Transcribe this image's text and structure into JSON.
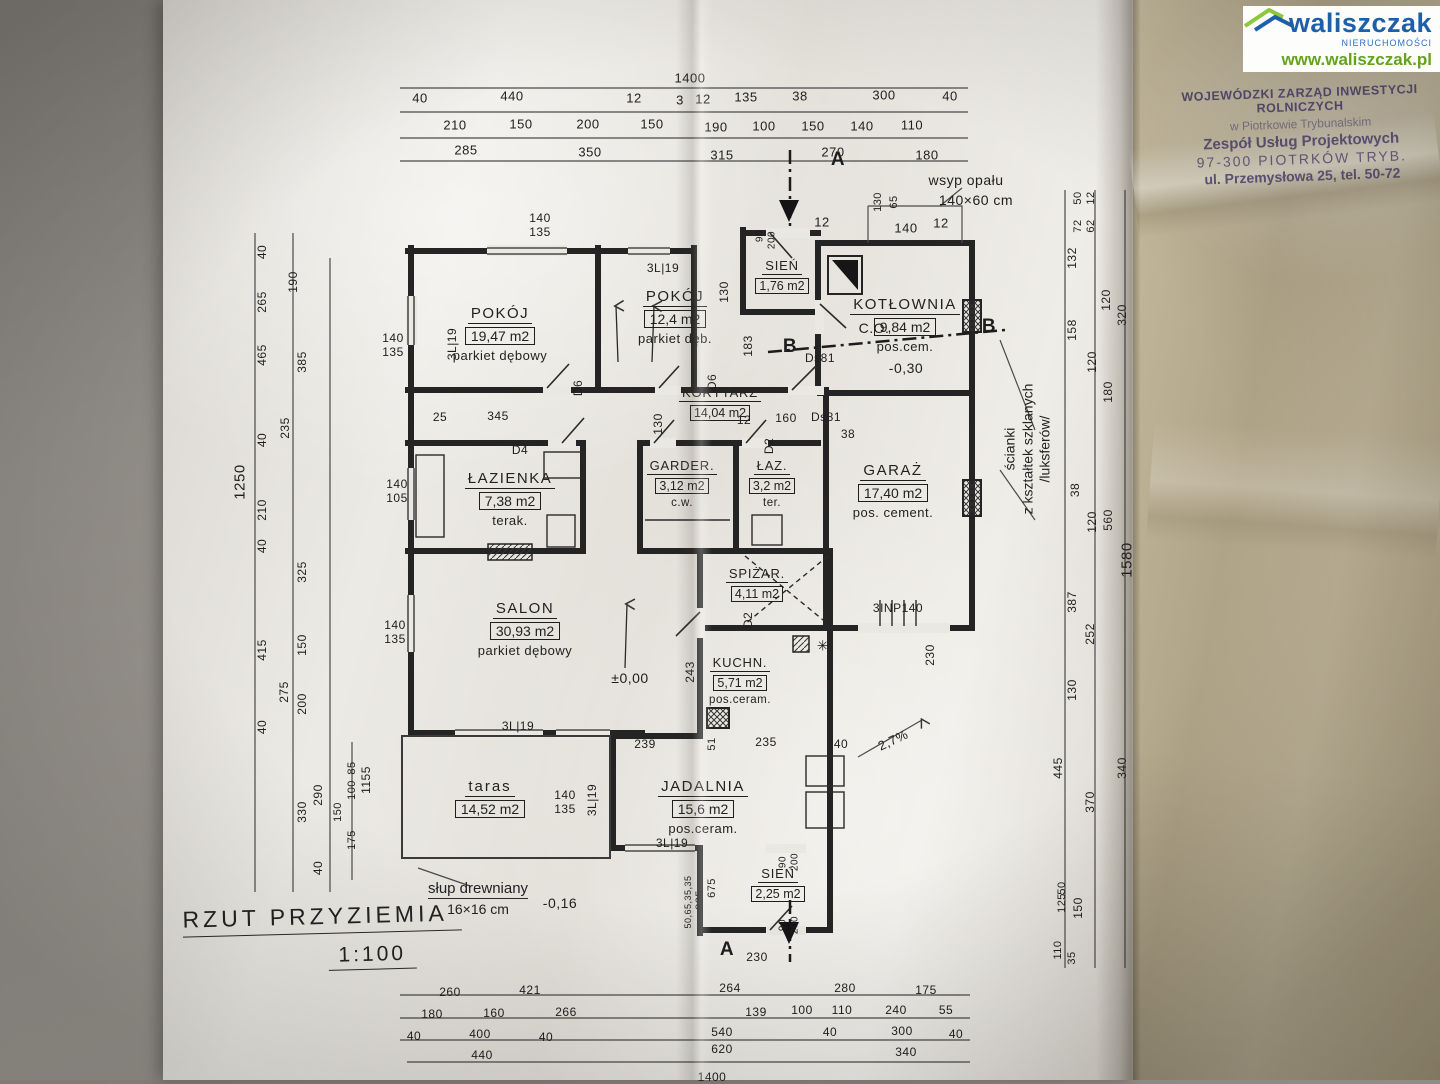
{
  "watermark": {
    "brand": "waliszczak",
    "subtitle": "NIERUCHOMOŚCI",
    "url": "www.waliszczak.pl",
    "brand_color": "#1d5fa8",
    "accent_green": "#8dc63f",
    "url_color": "#64a31c"
  },
  "stamp": {
    "line1": "WOJEWÓDZKI ZARZĄD INWESTYCJI ROLNICZYCH",
    "line2": "w Piotrkowie Trybunalskim",
    "line3": "Zespół Usług Projektowych",
    "line4": "97-300 PIOTRKÓW TRYB.",
    "line5": "ul. Przemysłowa 25, tel. 50-72",
    "ink_color": "#3d3560"
  },
  "title": {
    "text": "RZUT PRZYZIEMIA",
    "scale": "1:100"
  },
  "rooms": [
    {
      "name": "POKÓJ",
      "area": "19,47 m2",
      "floor": "parkiet dębowy"
    },
    {
      "name": "POKÓJ",
      "area": "12,4 m2",
      "floor": "parkiet dęb."
    },
    {
      "name": "SIEŃ",
      "area": "1,76 m2",
      "floor": ""
    },
    {
      "name": "KOTŁOWNIA",
      "area": "9,84 m2",
      "floor": "pos.cem."
    },
    {
      "name": "KORYTARZ",
      "area": "14,04 m2",
      "floor": ""
    },
    {
      "name": "ŁAZIENKA",
      "area": "7,38 m2",
      "floor": "terak."
    },
    {
      "name": "GARDER.",
      "area": "3,12 m2",
      "floor": "c.w."
    },
    {
      "name": "ŁAZ.",
      "area": "3,2 m2",
      "floor": "ter."
    },
    {
      "name": "GARAŻ",
      "area": "17,40 m2",
      "floor": "pos. cement."
    },
    {
      "name": "SALON",
      "area": "30,93 m2",
      "floor": "parkiet dębowy"
    },
    {
      "name": "SPIŻAR.",
      "area": "4,11 m2",
      "floor": ""
    },
    {
      "name": "KUCHN.",
      "area": "5,71 m2",
      "floor": "pos.ceram."
    },
    {
      "name": "taras",
      "area": "14,52 m2",
      "floor": ""
    },
    {
      "name": "JADALNIA",
      "area": "15,6 m2",
      "floor": "pos.ceram."
    },
    {
      "name": "SIEŃ",
      "area": "2,25 m2",
      "floor": ""
    }
  ],
  "annotations": {
    "glass_wall": {
      "l1": "ścianki",
      "l2": "z kształtek szklanych",
      "l3": "/luksferów/"
    },
    "post": {
      "l1": "słup drewniany",
      "l2": "16×16 cm"
    },
    "coal_chute": "wsyp opału 140×60 cm",
    "levels": [
      "±0,00",
      "-0,30",
      "-0,16"
    ],
    "slope": "2,7%",
    "stairs": "3INP140",
    "doors": [
      "Ds81",
      "D2",
      "D4",
      "D6"
    ],
    "windows": [
      "3L|19"
    ],
    "sections": [
      "A",
      "B"
    ]
  },
  "plan": {
    "labels": [
      {
        "t": "1400",
        "x": 690,
        "y": 78
      },
      {
        "t": "40",
        "x": 420,
        "y": 98
      },
      {
        "t": "440",
        "x": 512,
        "y": 96
      },
      {
        "t": "12",
        "x": 634,
        "y": 98
      },
      {
        "t": "3",
        "x": 680,
        "y": 100
      },
      {
        "t": "12",
        "x": 703,
        "y": 99
      },
      {
        "t": "135",
        "x": 746,
        "y": 97
      },
      {
        "t": "38",
        "x": 800,
        "y": 96
      },
      {
        "t": "300",
        "x": 884,
        "y": 95
      },
      {
        "t": "40",
        "x": 950,
        "y": 96
      },
      {
        "t": "210",
        "x": 455,
        "y": 125
      },
      {
        "t": "150",
        "x": 521,
        "y": 124
      },
      {
        "t": "200",
        "x": 588,
        "y": 124
      },
      {
        "t": "150",
        "x": 652,
        "y": 124
      },
      {
        "t": "190",
        "x": 716,
        "y": 127
      },
      {
        "t": "100",
        "x": 764,
        "y": 126
      },
      {
        "t": "150",
        "x": 813,
        "y": 126
      },
      {
        "t": "140",
        "x": 862,
        "y": 126
      },
      {
        "t": "110",
        "x": 912,
        "y": 125
      },
      {
        "t": "285",
        "x": 466,
        "y": 150
      },
      {
        "t": "350",
        "x": 590,
        "y": 152
      },
      {
        "t": "315",
        "x": 722,
        "y": 155
      },
      {
        "t": "270",
        "x": 833,
        "y": 152
      },
      {
        "t": "180",
        "x": 927,
        "y": 155
      },
      {
        "t": "wsyp opału",
        "x": 966,
        "y": 180,
        "s": 14
      },
      {
        "t": "140×60 cm",
        "x": 976,
        "y": 200,
        "s": 14
      },
      {
        "t": "130",
        "x": 878,
        "y": 202,
        "r": -90,
        "s": 11
      },
      {
        "t": "65",
        "x": 894,
        "y": 202,
        "r": -90,
        "s": 11
      },
      {
        "t": "140",
        "x": 906,
        "y": 228
      },
      {
        "t": "12",
        "x": 941,
        "y": 223
      },
      {
        "t": "12",
        "x": 822,
        "y": 222
      },
      {
        "t": "90",
        "x": 760,
        "y": 236,
        "r": -90,
        "s": 10
      },
      {
        "t": "200",
        "x": 772,
        "y": 240,
        "r": -90,
        "s": 10
      },
      {
        "t": "130",
        "x": 724,
        "y": 292,
        "r": -90,
        "s": 12
      },
      {
        "t": "183",
        "x": 748,
        "y": 346,
        "r": -90,
        "s": 12
      },
      {
        "t": "Ds81",
        "x": 820,
        "y": 358,
        "s": 12
      },
      {
        "t": "C.O.",
        "x": 874,
        "y": 328,
        "s": 14
      },
      {
        "t": "-0,30",
        "x": 906,
        "y": 368,
        "s": 14
      },
      {
        "t": "B",
        "x": 790,
        "y": 347,
        "b": 1
      },
      {
        "t": "B",
        "x": 989,
        "y": 327,
        "b": 1
      },
      {
        "t": "A",
        "x": 838,
        "y": 160,
        "b": 1
      },
      {
        "t": "A",
        "x": 727,
        "y": 950,
        "b": 1
      },
      {
        "t": "40",
        "x": 262,
        "y": 252,
        "r": -90,
        "s": 12
      },
      {
        "t": "190",
        "x": 293,
        "y": 282,
        "r": -90,
        "s": 12
      },
      {
        "t": "265",
        "x": 262,
        "y": 302,
        "r": -90,
        "s": 12
      },
      {
        "t": "465",
        "x": 262,
        "y": 355,
        "r": -90,
        "s": 12
      },
      {
        "t": "385",
        "x": 302,
        "y": 362,
        "r": -90,
        "s": 12
      },
      {
        "t": "235",
        "x": 285,
        "y": 428,
        "r": -90,
        "s": 12
      },
      {
        "t": "40",
        "x": 262,
        "y": 440,
        "r": -90,
        "s": 12
      },
      {
        "t": "1250",
        "x": 240,
        "y": 482,
        "r": -90,
        "s": 15
      },
      {
        "t": "210",
        "x": 262,
        "y": 510,
        "r": -90,
        "s": 12
      },
      {
        "t": "40",
        "x": 262,
        "y": 546,
        "r": -90,
        "s": 12
      },
      {
        "t": "325",
        "x": 302,
        "y": 572,
        "r": -90,
        "s": 12
      },
      {
        "t": "415",
        "x": 262,
        "y": 650,
        "r": -90,
        "s": 12
      },
      {
        "t": "150",
        "x": 302,
        "y": 645,
        "r": -90,
        "s": 12
      },
      {
        "t": "275",
        "x": 284,
        "y": 692,
        "r": -90,
        "s": 12
      },
      {
        "t": "200",
        "x": 302,
        "y": 704,
        "r": -90,
        "s": 12
      },
      {
        "t": "40",
        "x": 262,
        "y": 727,
        "r": -90,
        "s": 12
      },
      {
        "t": "85",
        "x": 352,
        "y": 768,
        "r": -90,
        "s": 11
      },
      {
        "t": "100",
        "x": 352,
        "y": 790,
        "r": -90,
        "s": 11
      },
      {
        "t": "150",
        "x": 338,
        "y": 812,
        "r": -90,
        "s": 11
      },
      {
        "t": "175",
        "x": 352,
        "y": 840,
        "r": -90,
        "s": 11
      },
      {
        "t": "290",
        "x": 318,
        "y": 795,
        "r": -90,
        "s": 12
      },
      {
        "t": "330",
        "x": 302,
        "y": 812,
        "r": -90,
        "s": 12
      },
      {
        "t": "40",
        "x": 318,
        "y": 868,
        "r": -90,
        "s": 12
      },
      {
        "t": "1155",
        "x": 366,
        "y": 780,
        "r": -90,
        "s": 12
      },
      {
        "t": "50",
        "x": 1078,
        "y": 198,
        "r": -90,
        "s": 11
      },
      {
        "t": "12",
        "x": 1091,
        "y": 198,
        "r": -90,
        "s": 11
      },
      {
        "t": "72",
        "x": 1078,
        "y": 226,
        "r": -90,
        "s": 11
      },
      {
        "t": "62",
        "x": 1091,
        "y": 226,
        "r": -90,
        "s": 11
      },
      {
        "t": "132",
        "x": 1072,
        "y": 258,
        "r": -90,
        "s": 12
      },
      {
        "t": "120",
        "x": 1106,
        "y": 300,
        "r": -90,
        "s": 12
      },
      {
        "t": "320",
        "x": 1122,
        "y": 315,
        "r": -90,
        "s": 12
      },
      {
        "t": "158",
        "x": 1072,
        "y": 330,
        "r": -90,
        "s": 12
      },
      {
        "t": "120",
        "x": 1092,
        "y": 362,
        "r": -90,
        "s": 12
      },
      {
        "t": "180",
        "x": 1108,
        "y": 392,
        "r": -90,
        "s": 12
      },
      {
        "t": "38",
        "x": 1075,
        "y": 490,
        "r": -90,
        "s": 12
      },
      {
        "t": "120",
        "x": 1092,
        "y": 522,
        "r": -90,
        "s": 12
      },
      {
        "t": "560",
        "x": 1108,
        "y": 520,
        "r": -90,
        "s": 12
      },
      {
        "t": "1580",
        "x": 1127,
        "y": 560,
        "r": -90,
        "s": 15
      },
      {
        "t": "387",
        "x": 1072,
        "y": 602,
        "r": -90,
        "s": 12
      },
      {
        "t": "252",
        "x": 1090,
        "y": 634,
        "r": -90,
        "s": 12
      },
      {
        "t": "130",
        "x": 1072,
        "y": 690,
        "r": -90,
        "s": 12
      },
      {
        "t": "445",
        "x": 1058,
        "y": 768,
        "r": -90,
        "s": 12
      },
      {
        "t": "370",
        "x": 1090,
        "y": 802,
        "r": -90,
        "s": 12
      },
      {
        "t": "340",
        "x": 1122,
        "y": 768,
        "r": -90,
        "s": 12
      },
      {
        "t": "50",
        "x": 1062,
        "y": 888,
        "r": -90,
        "s": 11
      },
      {
        "t": "125",
        "x": 1062,
        "y": 903,
        "r": -90,
        "s": 11
      },
      {
        "t": "150",
        "x": 1078,
        "y": 908,
        "r": -90,
        "s": 12
      },
      {
        "t": "110",
        "x": 1058,
        "y": 950,
        "r": -90,
        "s": 11
      },
      {
        "t": "35",
        "x": 1072,
        "y": 958,
        "r": -90,
        "s": 11
      },
      {
        "t": "140",
        "x": 540,
        "y": 218,
        "s": 12
      },
      {
        "t": "135",
        "x": 540,
        "y": 232,
        "s": 12
      },
      {
        "t": "3L|19",
        "x": 663,
        "y": 268,
        "s": 12
      },
      {
        "t": "3L|19",
        "x": 452,
        "y": 344,
        "r": -90,
        "s": 12
      },
      {
        "t": "140",
        "x": 393,
        "y": 338,
        "s": 12
      },
      {
        "t": "135",
        "x": 393,
        "y": 352,
        "s": 12
      },
      {
        "t": "140",
        "x": 397,
        "y": 484,
        "s": 12
      },
      {
        "t": "105",
        "x": 397,
        "y": 498,
        "s": 12
      },
      {
        "t": "140",
        "x": 395,
        "y": 625,
        "s": 12
      },
      {
        "t": "135",
        "x": 395,
        "y": 639,
        "s": 12
      },
      {
        "t": "3L|19",
        "x": 518,
        "y": 726,
        "s": 12
      },
      {
        "t": "140",
        "x": 565,
        "y": 795,
        "s": 12
      },
      {
        "t": "135",
        "x": 565,
        "y": 809,
        "s": 12
      },
      {
        "t": "3L|19",
        "x": 592,
        "y": 800,
        "r": -90,
        "s": 12
      },
      {
        "t": "3L|19",
        "x": 672,
        "y": 843,
        "s": 12
      },
      {
        "t": "345",
        "x": 498,
        "y": 416,
        "s": 12
      },
      {
        "t": "25",
        "x": 440,
        "y": 417,
        "s": 12
      },
      {
        "t": "D4",
        "x": 520,
        "y": 450,
        "s": 12
      },
      {
        "t": "D6",
        "x": 578,
        "y": 388,
        "r": -90,
        "s": 12
      },
      {
        "t": "130",
        "x": 658,
        "y": 424,
        "r": -90,
        "s": 12
      },
      {
        "t": "D6",
        "x": 712,
        "y": 382,
        "r": -90,
        "s": 12
      },
      {
        "t": "12",
        "x": 744,
        "y": 420,
        "s": 12
      },
      {
        "t": "160",
        "x": 786,
        "y": 418,
        "s": 12
      },
      {
        "t": "Ds81",
        "x": 826,
        "y": 417,
        "s": 12
      },
      {
        "t": "38",
        "x": 848,
        "y": 434,
        "s": 12
      },
      {
        "t": "D2",
        "x": 769,
        "y": 446,
        "r": -90,
        "s": 12
      },
      {
        "t": "D2",
        "x": 748,
        "y": 620,
        "r": -90,
        "s": 12
      },
      {
        "t": "243",
        "x": 690,
        "y": 672,
        "r": -90,
        "s": 12
      },
      {
        "t": "±0,00",
        "x": 630,
        "y": 678,
        "s": 14
      },
      {
        "t": "239",
        "x": 645,
        "y": 744,
        "s": 12
      },
      {
        "t": "51",
        "x": 712,
        "y": 744,
        "r": -90,
        "s": 11
      },
      {
        "t": "235",
        "x": 766,
        "y": 742,
        "s": 12
      },
      {
        "t": "40",
        "x": 841,
        "y": 744,
        "s": 12
      },
      {
        "t": "2,7%",
        "x": 893,
        "y": 740,
        "r": -25,
        "s": 13
      },
      {
        "t": "3INP140",
        "x": 898,
        "y": 608,
        "s": 12
      },
      {
        "t": "230",
        "x": 930,
        "y": 655,
        "r": -90,
        "s": 12
      },
      {
        "t": "230",
        "x": 757,
        "y": 957,
        "s": 12
      },
      {
        "t": "✳",
        "x": 823,
        "y": 646,
        "s": 14
      },
      {
        "t": "90",
        "x": 783,
        "y": 862,
        "r": -90,
        "s": 10
      },
      {
        "t": "200",
        "x": 795,
        "y": 862,
        "r": -90,
        "s": 10
      },
      {
        "t": "90",
        "x": 783,
        "y": 925,
        "r": -90,
        "s": 10
      },
      {
        "t": "200",
        "x": 795,
        "y": 925,
        "r": -90,
        "s": 10
      },
      {
        "t": "825",
        "x": 700,
        "y": 900,
        "r": -90,
        "s": 11
      },
      {
        "t": "675",
        "x": 712,
        "y": 888,
        "r": -90,
        "s": 11
      },
      {
        "t": "50,65,35,35",
        "x": 688,
        "y": 902,
        "r": -90,
        "s": 9
      },
      {
        "t": "-0,16",
        "x": 560,
        "y": 903,
        "s": 14
      },
      {
        "t": "260",
        "x": 450,
        "y": 992,
        "s": 12
      },
      {
        "t": "421",
        "x": 530,
        "y": 990,
        "s": 12
      },
      {
        "t": "264",
        "x": 730,
        "y": 988,
        "s": 12
      },
      {
        "t": "280",
        "x": 845,
        "y": 988,
        "s": 12
      },
      {
        "t": "175",
        "x": 926,
        "y": 990,
        "s": 12
      },
      {
        "t": "180",
        "x": 432,
        "y": 1014,
        "s": 12
      },
      {
        "t": "160",
        "x": 494,
        "y": 1013,
        "s": 12
      },
      {
        "t": "266",
        "x": 566,
        "y": 1012,
        "s": 12
      },
      {
        "t": "139",
        "x": 756,
        "y": 1012,
        "s": 12
      },
      {
        "t": "100",
        "x": 802,
        "y": 1010,
        "s": 12
      },
      {
        "t": "110",
        "x": 842,
        "y": 1010,
        "s": 12
      },
      {
        "t": "240",
        "x": 896,
        "y": 1010,
        "s": 12
      },
      {
        "t": "55",
        "x": 946,
        "y": 1010,
        "s": 12
      },
      {
        "t": "40",
        "x": 414,
        "y": 1036,
        "s": 12
      },
      {
        "t": "400",
        "x": 480,
        "y": 1034,
        "s": 12
      },
      {
        "t": "40",
        "x": 546,
        "y": 1037,
        "s": 12
      },
      {
        "t": "540",
        "x": 722,
        "y": 1032,
        "s": 12
      },
      {
        "t": "40",
        "x": 830,
        "y": 1032,
        "s": 12
      },
      {
        "t": "300",
        "x": 902,
        "y": 1031,
        "s": 12
      },
      {
        "t": "40",
        "x": 956,
        "y": 1034,
        "s": 12
      },
      {
        "t": "440",
        "x": 482,
        "y": 1055,
        "s": 12
      },
      {
        "t": "620",
        "x": 722,
        "y": 1049,
        "s": 12
      },
      {
        "t": "340",
        "x": 906,
        "y": 1052,
        "s": 12
      },
      {
        "t": "1400",
        "x": 712,
        "y": 1077,
        "s": 12
      }
    ]
  }
}
